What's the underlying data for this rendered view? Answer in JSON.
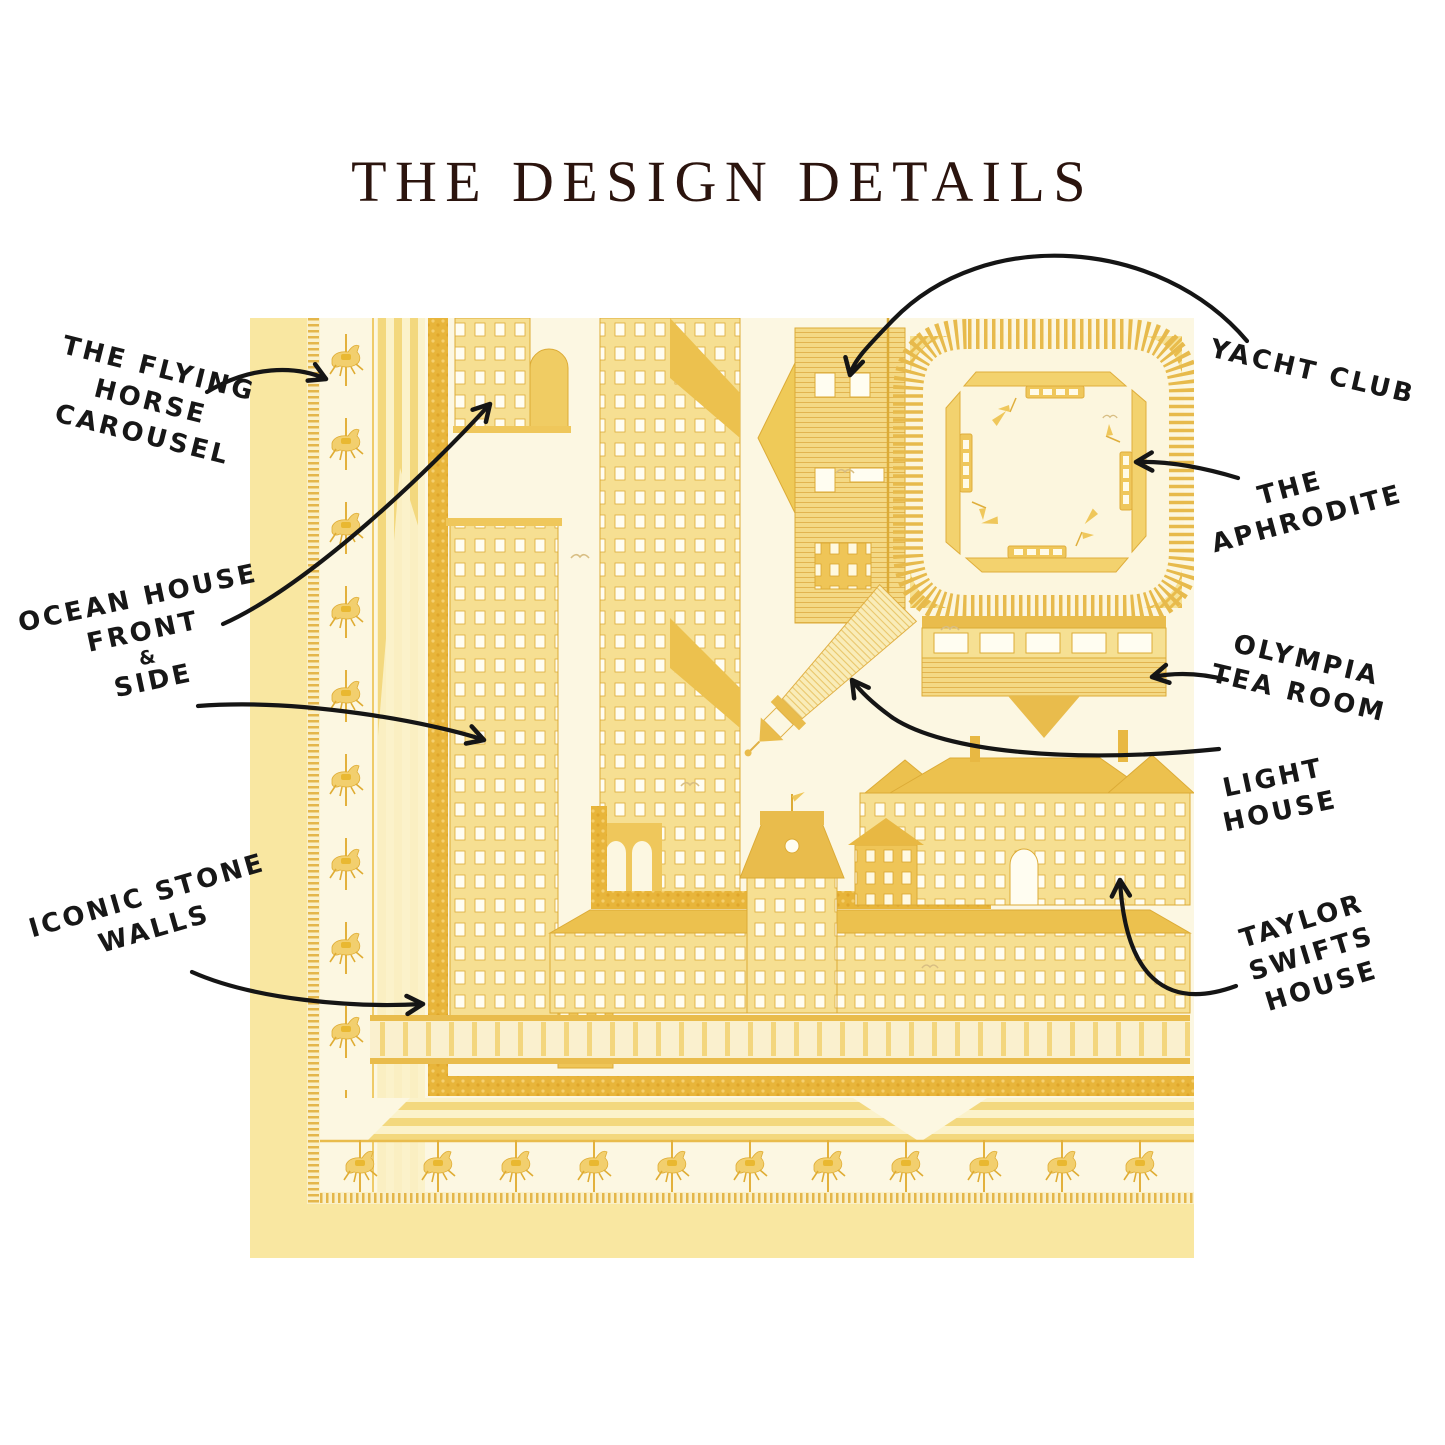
{
  "title": "THE DESIGN DETAILS",
  "annotations": {
    "flying_horse_carousel": {
      "lines": [
        "THE FLYING",
        "HORSE",
        "CAROUSEL"
      ]
    },
    "ocean_house": {
      "lines": [
        "OCEAN HOUSE",
        "FRONT",
        "&",
        "SIDE"
      ]
    },
    "iconic_stone_walls": {
      "lines": [
        "ICONIC STONE",
        "WALLS"
      ]
    },
    "yacht_club": {
      "lines": [
        "YACHT CLUB"
      ]
    },
    "the_aphrodite": {
      "lines": [
        "THE",
        "APHRODITE"
      ]
    },
    "olympia_tea_room": {
      "lines": [
        "OLYMPIA",
        "TEA ROOM"
      ]
    },
    "light_house": {
      "lines": [
        "LIGHT",
        "HOUSE"
      ]
    },
    "taylor_swifts_house": {
      "lines": [
        "TAYLOR",
        "SWIFTS",
        "HOUSE"
      ]
    }
  },
  "colors": {
    "ink": "#171717",
    "title": "#2b140e",
    "scarf_pale_band": "#f9e7a1",
    "scarf_cream": "#fcf7e2",
    "scarf_mid_yellow": "#efc75b",
    "scarf_gold": "#e8b53a"
  }
}
